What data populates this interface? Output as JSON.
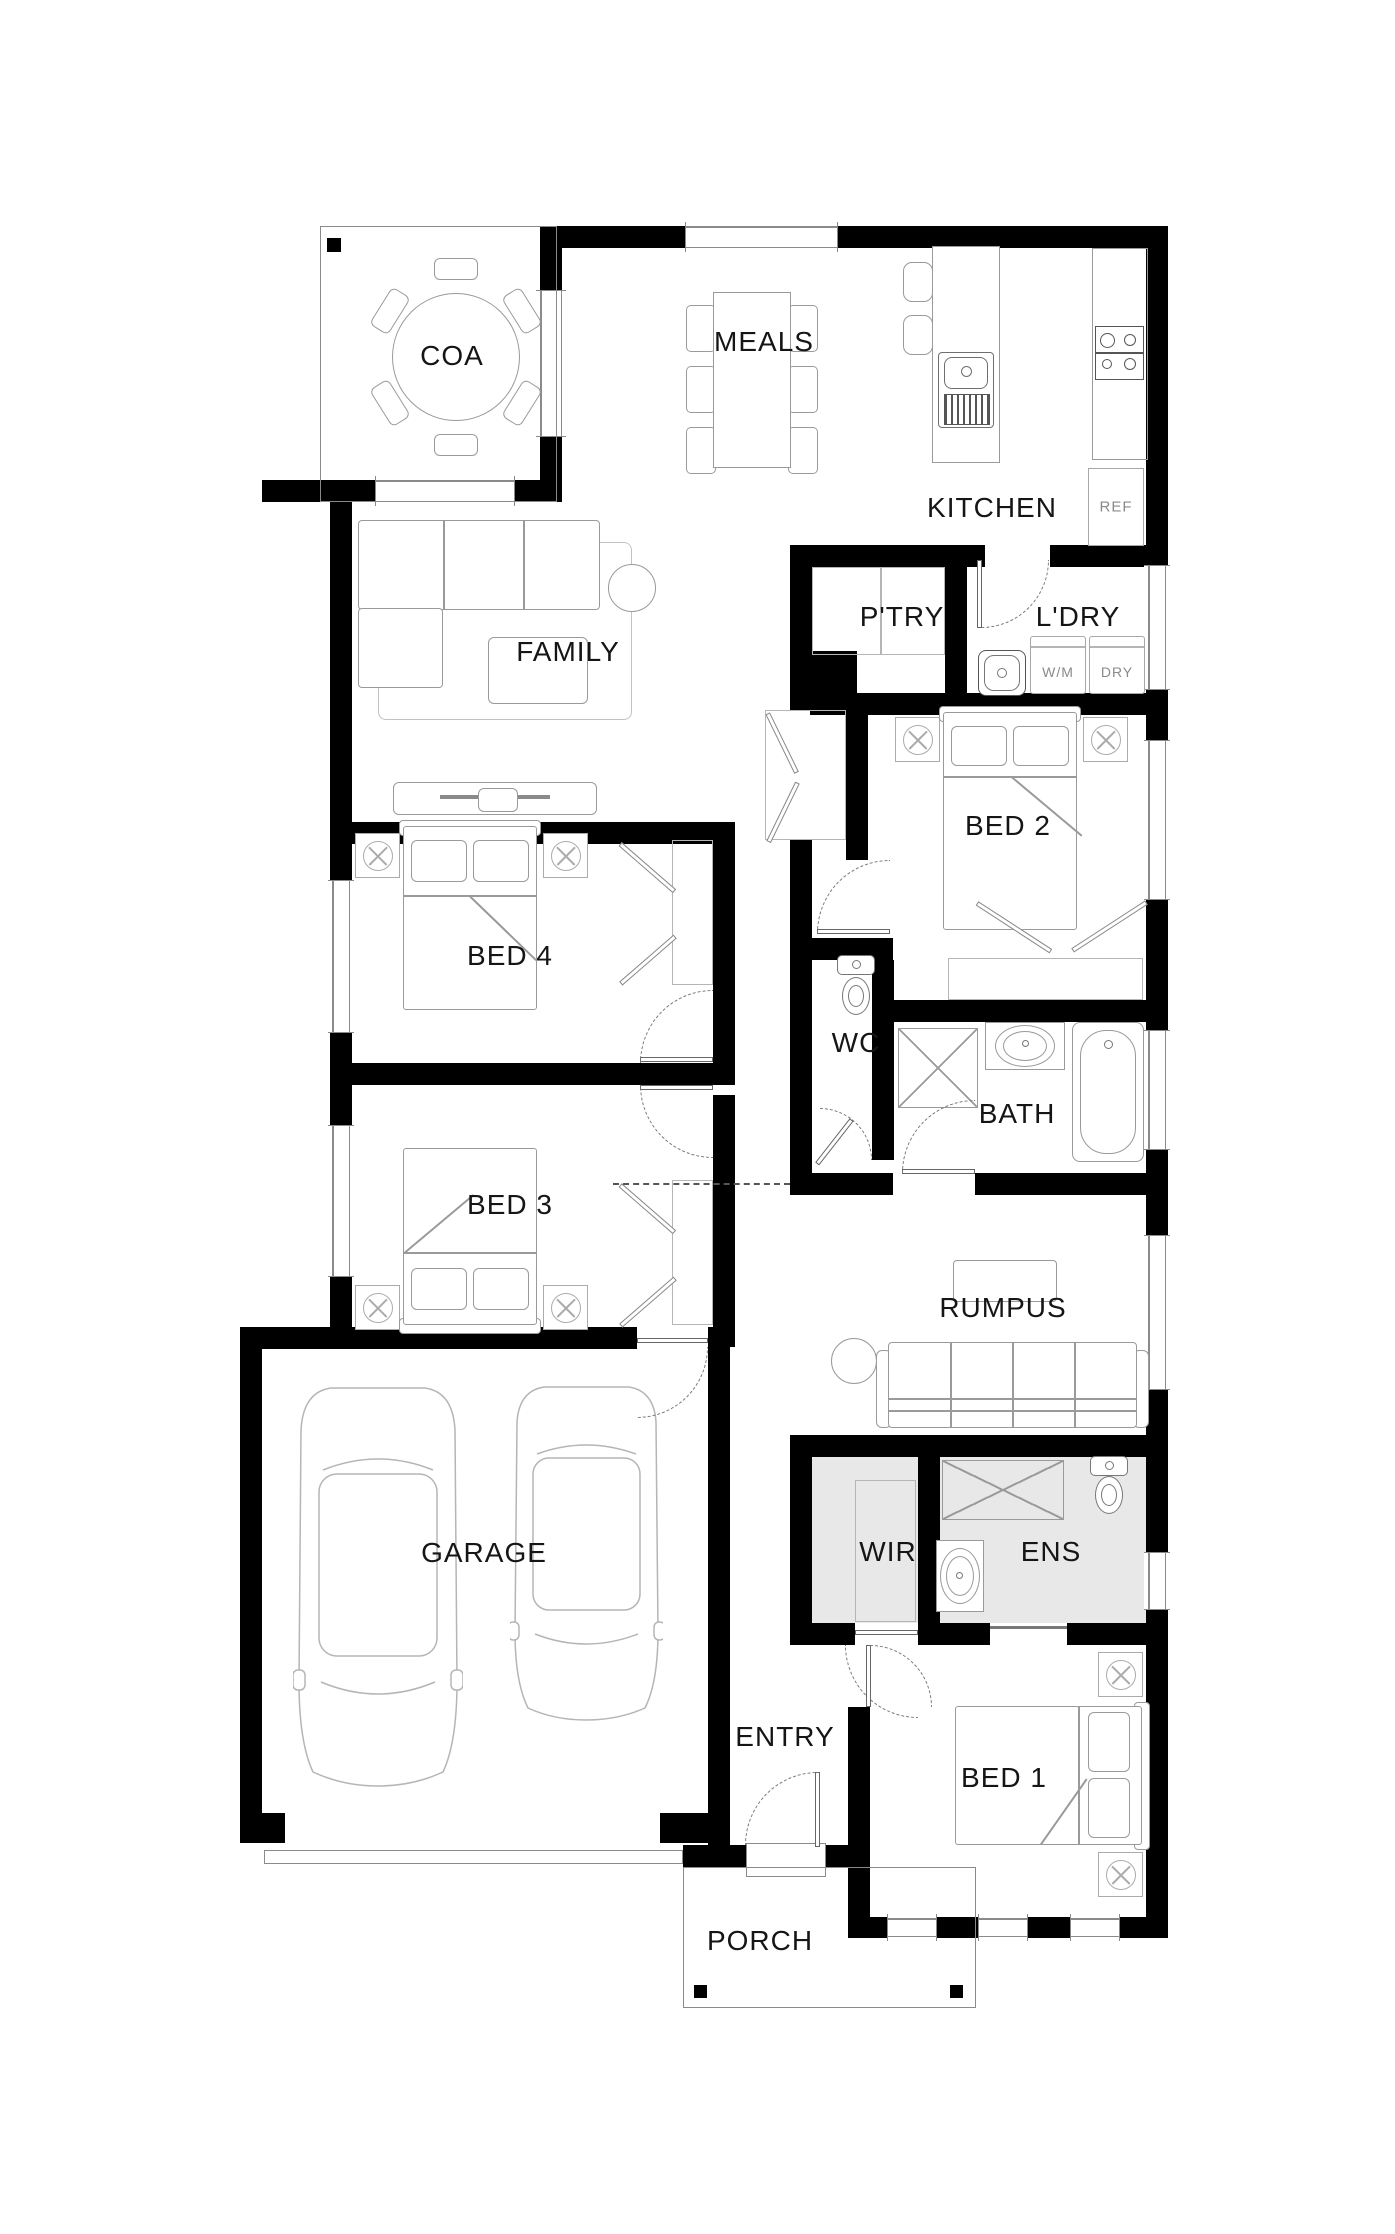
{
  "plan": {
    "title_note": "single storey house floor plan",
    "rooms": [
      {
        "id": "coa",
        "label": "COA"
      },
      {
        "id": "meals",
        "label": "MEALS"
      },
      {
        "id": "kitchen",
        "label": "KITCHEN"
      },
      {
        "id": "ptry",
        "label": "P'TRY"
      },
      {
        "id": "ldry",
        "label": "L'DRY"
      },
      {
        "id": "family",
        "label": "FAMILY"
      },
      {
        "id": "bed2",
        "label": "BED 2"
      },
      {
        "id": "bed4",
        "label": "BED 4"
      },
      {
        "id": "wc",
        "label": "WC"
      },
      {
        "id": "bath",
        "label": "BATH"
      },
      {
        "id": "bed3",
        "label": "BED 3"
      },
      {
        "id": "rumpus",
        "label": "RUMPUS"
      },
      {
        "id": "garage",
        "label": "GARAGE"
      },
      {
        "id": "wir",
        "label": "WIR"
      },
      {
        "id": "ens",
        "label": "ENS"
      },
      {
        "id": "entry",
        "label": "ENTRY"
      },
      {
        "id": "bed1",
        "label": "BED 1"
      },
      {
        "id": "porch",
        "label": "PORCH"
      }
    ],
    "appliances": {
      "fridge": "REF",
      "washing_machine": "W/M",
      "dryer": "DRY"
    },
    "colors": {
      "wall": "#000000",
      "furniture_line": "#9a9a9a",
      "wet_area_floor": "#e8e8e8",
      "background": "#ffffff",
      "label_text": "#151515"
    }
  }
}
